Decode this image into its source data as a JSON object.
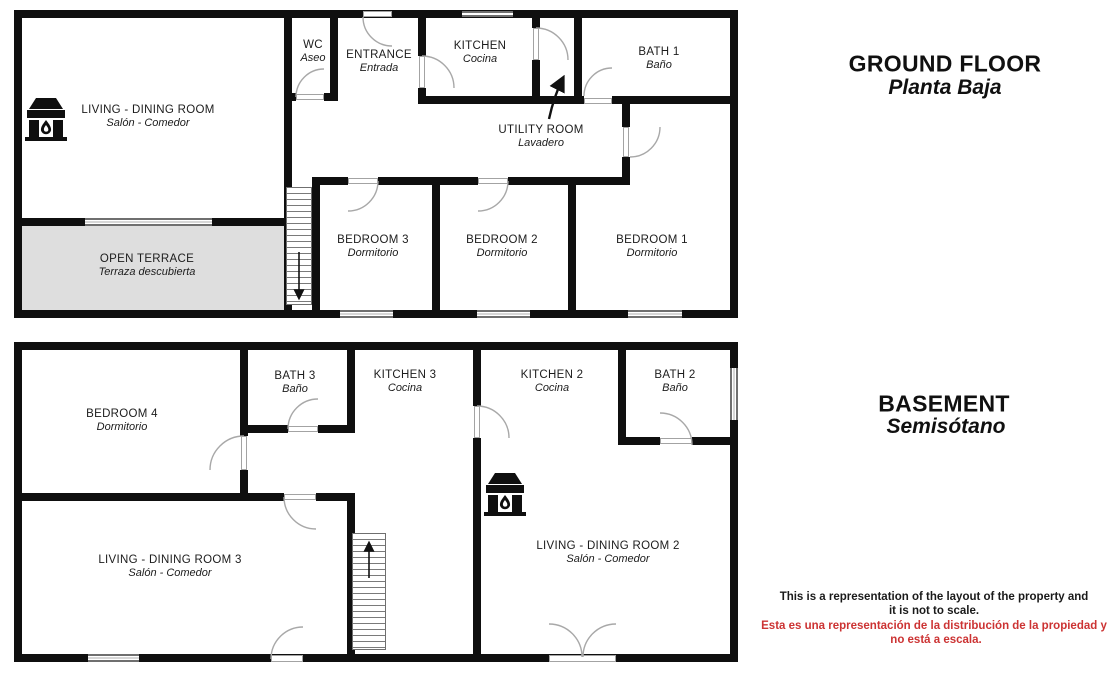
{
  "ground_floor": {
    "heading": "GROUND FLOOR",
    "subheading": "Planta Baja",
    "rooms": {
      "living_dining": {
        "name": "LIVING - DINING ROOM",
        "sub": "Salón - Comedor"
      },
      "wc": {
        "name": "WC",
        "sub": "Aseo"
      },
      "entrance": {
        "name": "ENTRANCE",
        "sub": "Entrada"
      },
      "kitchen": {
        "name": "KITCHEN",
        "sub": "Cocina"
      },
      "utility": {
        "name": "UTILITY ROOM",
        "sub": "Lavadero"
      },
      "bath1": {
        "name": "BATH 1",
        "sub": "Baño"
      },
      "terrace": {
        "name": "OPEN TERRACE",
        "sub": "Terraza descubierta"
      },
      "bedroom3": {
        "name": "BEDROOM 3",
        "sub": "Dormitorio"
      },
      "bedroom2": {
        "name": "BEDROOM 2",
        "sub": "Dormitorio"
      },
      "bedroom1": {
        "name": "BEDROOM 1",
        "sub": "Dormitorio"
      }
    }
  },
  "basement": {
    "heading": "BASEMENT",
    "subheading": "Semisótano",
    "rooms": {
      "bedroom4": {
        "name": "BEDROOM 4",
        "sub": "Dormitorio"
      },
      "bath3": {
        "name": "BATH 3",
        "sub": "Baño"
      },
      "kitchen3": {
        "name": "KITCHEN 3",
        "sub": "Cocina"
      },
      "kitchen2": {
        "name": "KITCHEN 2",
        "sub": "Cocina"
      },
      "bath2": {
        "name": "BATH 2",
        "sub": "Baño"
      },
      "living3": {
        "name": "LIVING - DINING ROOM 3",
        "sub": "Salón - Comedor"
      },
      "living2": {
        "name": "LIVING - DINING ROOM 2",
        "sub": "Salón - Comedor"
      }
    }
  },
  "disclaimer": {
    "en_line1": "This is a representation of the layout of the property and",
    "en_line2": "it is not to scale.",
    "es_line1": "Esta es una representación de la distribución de la propiedad y",
    "es_line2": "no está a escala."
  },
  "colors": {
    "wall": "#0f0f0f",
    "terrace_fill": "#dedede",
    "disclaimer_en": "#1a1a1a",
    "disclaimer_es": "#cc3333"
  },
  "icons": {
    "fireplace": "fireplace-icon",
    "utility_arrow": "arrow-up-icon",
    "stairs_ground": "stairs-down-icon",
    "stairs_basement": "stairs-up-icon"
  }
}
